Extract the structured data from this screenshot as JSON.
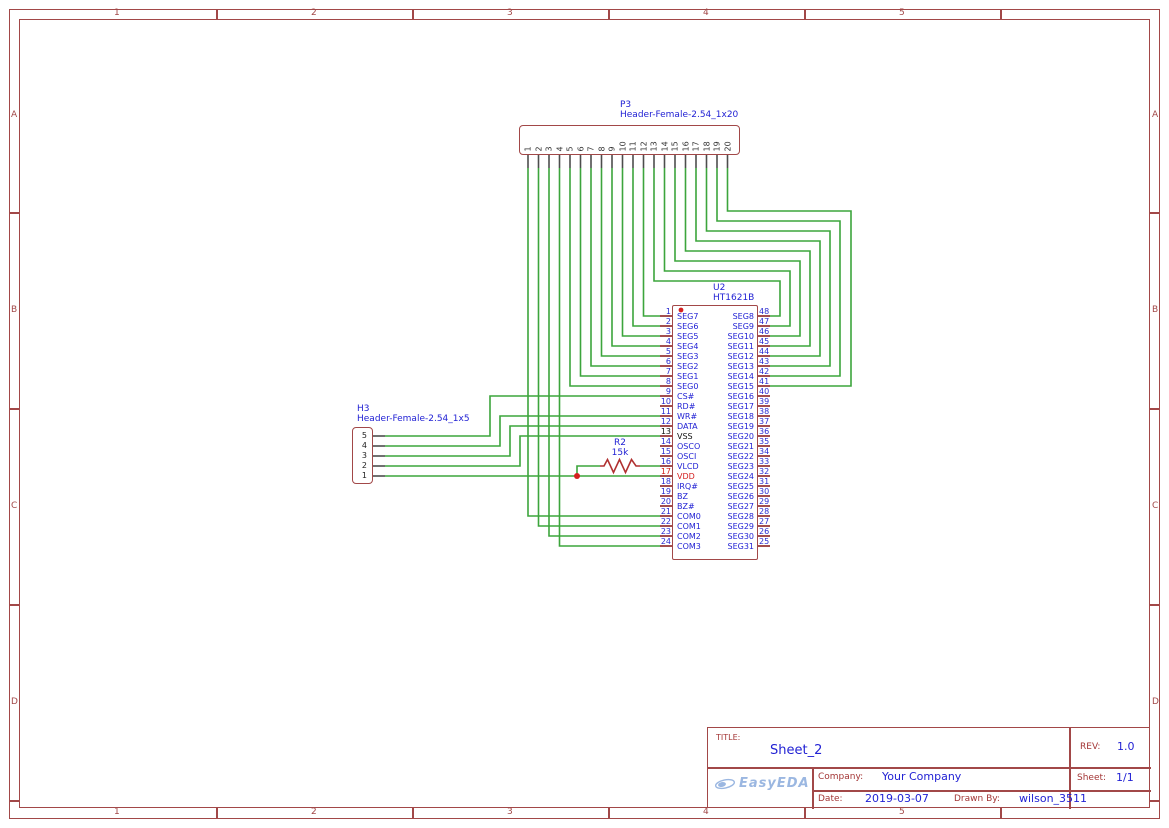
{
  "sheet": {
    "cols": [
      "1",
      "2",
      "3",
      "4",
      "5"
    ],
    "rows": [
      "A",
      "B",
      "C",
      "D"
    ]
  },
  "title_block": {
    "title_label": "TITLE:",
    "title": "Sheet_2",
    "rev_label": "REV:",
    "rev": "1.0",
    "logo_text": "EasyEDA",
    "company_label": "Company:",
    "company": "Your Company",
    "sheet_label": "Sheet:",
    "sheet": "1/1",
    "date_label": "Date:",
    "date": "2019-03-07",
    "drawn_by_label": "Drawn By:",
    "drawn_by": "wilson_3511"
  },
  "components": {
    "p3": {
      "ref": "P3",
      "value": "Header-Female-2.54_1x20",
      "pins": [
        "1",
        "2",
        "3",
        "4",
        "5",
        "6",
        "7",
        "8",
        "9",
        "10",
        "11",
        "12",
        "13",
        "14",
        "15",
        "16",
        "17",
        "18",
        "19",
        "20"
      ]
    },
    "h3": {
      "ref": "H3",
      "value": "Header-Female-2.54_1x5",
      "pins": [
        "5",
        "4",
        "3",
        "2",
        "1"
      ]
    },
    "u2": {
      "ref": "U2",
      "value": "HT1621B",
      "left_pins": [
        {
          "num": "1",
          "name": "SEG7"
        },
        {
          "num": "2",
          "name": "SEG6"
        },
        {
          "num": "3",
          "name": "SEG5"
        },
        {
          "num": "4",
          "name": "SEG4"
        },
        {
          "num": "5",
          "name": "SEG3"
        },
        {
          "num": "6",
          "name": "SEG2"
        },
        {
          "num": "7",
          "name": "SEG1"
        },
        {
          "num": "8",
          "name": "SEG0"
        },
        {
          "num": "9",
          "name": "CS#"
        },
        {
          "num": "10",
          "name": "RD#"
        },
        {
          "num": "11",
          "name": "WR#"
        },
        {
          "num": "12",
          "name": "DATA"
        },
        {
          "num": "13",
          "name": "VSS",
          "style": "power_gnd"
        },
        {
          "num": "14",
          "name": "OSCO"
        },
        {
          "num": "15",
          "name": "OSCI"
        },
        {
          "num": "16",
          "name": "VLCD"
        },
        {
          "num": "17",
          "name": "VDD",
          "style": "power_pos"
        },
        {
          "num": "18",
          "name": "IRQ#"
        },
        {
          "num": "19",
          "name": "BZ"
        },
        {
          "num": "20",
          "name": "BZ#"
        },
        {
          "num": "21",
          "name": "COM0"
        },
        {
          "num": "22",
          "name": "COM1"
        },
        {
          "num": "23",
          "name": "COM2"
        },
        {
          "num": "24",
          "name": "COM3"
        }
      ],
      "right_pins": [
        {
          "num": "48",
          "name": "SEG8"
        },
        {
          "num": "47",
          "name": "SEG9"
        },
        {
          "num": "46",
          "name": "SEG10"
        },
        {
          "num": "45",
          "name": "SEG11"
        },
        {
          "num": "44",
          "name": "SEG12"
        },
        {
          "num": "43",
          "name": "SEG13"
        },
        {
          "num": "42",
          "name": "SEG14"
        },
        {
          "num": "41",
          "name": "SEG15"
        },
        {
          "num": "40",
          "name": "SEG16"
        },
        {
          "num": "39",
          "name": "SEG17"
        },
        {
          "num": "38",
          "name": "SEG18"
        },
        {
          "num": "37",
          "name": "SEG19"
        },
        {
          "num": "36",
          "name": "SEG20"
        },
        {
          "num": "35",
          "name": "SEG21"
        },
        {
          "num": "34",
          "name": "SEG22"
        },
        {
          "num": "33",
          "name": "SEG23"
        },
        {
          "num": "32",
          "name": "SEG24"
        },
        {
          "num": "31",
          "name": "SEG25"
        },
        {
          "num": "30",
          "name": "SEG26"
        },
        {
          "num": "29",
          "name": "SEG27"
        },
        {
          "num": "28",
          "name": "SEG28"
        },
        {
          "num": "27",
          "name": "SEG29"
        },
        {
          "num": "26",
          "name": "SEG30"
        },
        {
          "num": "25",
          "name": "SEG31"
        }
      ]
    },
    "r2": {
      "ref": "R2",
      "value": "15k"
    }
  },
  "colors": {
    "wire": "#3ca53c",
    "outline": "#a24848",
    "ic_pin": "#8c2222",
    "header_pin": "#4d4d4d",
    "junction": "#d42020",
    "resistor": "#b03030",
    "blue_text": "#2222d4",
    "gnd_text": "#111111",
    "power_text": "#d42020",
    "title_red": "#a33636",
    "logo_blue": "#8aabdc"
  },
  "nets": [
    {
      "from": "P3.1",
      "to": "U2.21 COM0",
      "points": [
        [
          528,
          168
        ],
        [
          528,
          516
        ],
        [
          660,
          516
        ]
      ]
    },
    {
      "from": "P3.2",
      "to": "U2.22 COM1",
      "points": [
        [
          538.5,
          168
        ],
        [
          538.5,
          526
        ],
        [
          660,
          526
        ]
      ]
    },
    {
      "from": "P3.3",
      "to": "U2.23 COM2",
      "points": [
        [
          549,
          168
        ],
        [
          549,
          536
        ],
        [
          660,
          536
        ]
      ]
    },
    {
      "from": "P3.4",
      "to": "U2.24 COM3",
      "points": [
        [
          559.5,
          168
        ],
        [
          559.5,
          546
        ],
        [
          660,
          546
        ]
      ]
    },
    {
      "from": "P3.5",
      "to": "U2.8 SEG0",
      "points": [
        [
          570,
          168
        ],
        [
          570,
          386
        ],
        [
          660,
          386
        ]
      ]
    },
    {
      "from": "P3.6",
      "to": "U2.7 SEG1",
      "points": [
        [
          580.5,
          168
        ],
        [
          580.5,
          376
        ],
        [
          660,
          376
        ]
      ]
    },
    {
      "from": "P3.7",
      "to": "U2.6 SEG2",
      "points": [
        [
          591,
          168
        ],
        [
          591,
          366
        ],
        [
          660,
          366
        ]
      ]
    },
    {
      "from": "P3.8",
      "to": "U2.5 SEG3",
      "points": [
        [
          601.5,
          168
        ],
        [
          601.5,
          356
        ],
        [
          660,
          356
        ]
      ]
    },
    {
      "from": "P3.9",
      "to": "U2.4 SEG4",
      "points": [
        [
          612,
          168
        ],
        [
          612,
          346
        ],
        [
          660,
          346
        ]
      ]
    },
    {
      "from": "P3.10",
      "to": "U2.3 SEG5",
      "points": [
        [
          622.5,
          168
        ],
        [
          622.5,
          336
        ],
        [
          660,
          336
        ]
      ]
    },
    {
      "from": "P3.11",
      "to": "U2.2 SEG6",
      "points": [
        [
          633,
          168
        ],
        [
          633,
          326
        ],
        [
          660,
          326
        ]
      ]
    },
    {
      "from": "P3.12",
      "to": "U2.1 SEG7",
      "points": [
        [
          643.5,
          168
        ],
        [
          643.5,
          316
        ],
        [
          660,
          316
        ]
      ]
    },
    {
      "from": "P3.13",
      "to": "U2.48 SEG8",
      "points": [
        [
          654,
          168
        ],
        [
          654,
          281
        ],
        [
          780,
          281
        ],
        [
          780,
          316
        ],
        [
          770,
          316
        ]
      ]
    },
    {
      "from": "P3.14",
      "to": "U2.47 SEG9",
      "points": [
        [
          664.5,
          168
        ],
        [
          664.5,
          271
        ],
        [
          790,
          271
        ],
        [
          790,
          326
        ],
        [
          770,
          326
        ]
      ]
    },
    {
      "from": "P3.15",
      "to": "U2.46 SEG10",
      "points": [
        [
          675,
          168
        ],
        [
          675,
          261
        ],
        [
          800,
          261
        ],
        [
          800,
          336
        ],
        [
          770,
          336
        ]
      ]
    },
    {
      "from": "P3.16",
      "to": "U2.45 SEG11",
      "points": [
        [
          685.5,
          168
        ],
        [
          685.5,
          251
        ],
        [
          810,
          251
        ],
        [
          810,
          346
        ],
        [
          770,
          346
        ]
      ]
    },
    {
      "from": "P3.17",
      "to": "U2.44 SEG12",
      "points": [
        [
          696,
          168
        ],
        [
          696,
          241
        ],
        [
          820,
          241
        ],
        [
          820,
          356
        ],
        [
          770,
          356
        ]
      ]
    },
    {
      "from": "P3.18",
      "to": "U2.43 SEG13",
      "points": [
        [
          706.5,
          168
        ],
        [
          706.5,
          231
        ],
        [
          830,
          231
        ],
        [
          830,
          366
        ],
        [
          770,
          366
        ]
      ]
    },
    {
      "from": "P3.19",
      "to": "U2.42 SEG14",
      "points": [
        [
          717,
          168
        ],
        [
          717,
          221
        ],
        [
          840,
          221
        ],
        [
          840,
          376
        ],
        [
          770,
          376
        ]
      ]
    },
    {
      "from": "P3.20",
      "to": "U2.41 SEG15",
      "points": [
        [
          727.5,
          168
        ],
        [
          727.5,
          211
        ],
        [
          851,
          211
        ],
        [
          851,
          386
        ],
        [
          770,
          386
        ]
      ]
    },
    {
      "from": "H3.5",
      "to": "U2.9 CS#",
      "points": [
        [
          385,
          436
        ],
        [
          490,
          436
        ],
        [
          490,
          396
        ],
        [
          660,
          396
        ]
      ]
    },
    {
      "from": "H3.4",
      "to": "U2.11 WR#",
      "points": [
        [
          385,
          446
        ],
        [
          500,
          446
        ],
        [
          500,
          416
        ],
        [
          660,
          416
        ]
      ]
    },
    {
      "from": "H3.3",
      "to": "U2.12 DATA",
      "points": [
        [
          385,
          456
        ],
        [
          510,
          456
        ],
        [
          510,
          426
        ],
        [
          660,
          426
        ]
      ]
    },
    {
      "from": "H3.2",
      "to": "U2.13 VSS",
      "points": [
        [
          385,
          466
        ],
        [
          520,
          466
        ],
        [
          520,
          436
        ],
        [
          660,
          436
        ]
      ]
    },
    {
      "from": "H3.1",
      "to": "U2.17 VDD",
      "points": [
        [
          385,
          476
        ],
        [
          660,
          476
        ]
      ]
    },
    {
      "from": "R2.1",
      "to": "VDD net junction",
      "points": [
        [
          577,
          476
        ],
        [
          577,
          466
        ],
        [
          600,
          466
        ]
      ]
    },
    {
      "from": "R2.2",
      "to": "U2.16 VLCD",
      "points": [
        [
          640,
          466
        ],
        [
          660,
          466
        ]
      ]
    }
  ],
  "junction": {
    "x": 577,
    "y": 476
  },
  "pin1_marker": {
    "x": 681,
    "y": 310
  }
}
